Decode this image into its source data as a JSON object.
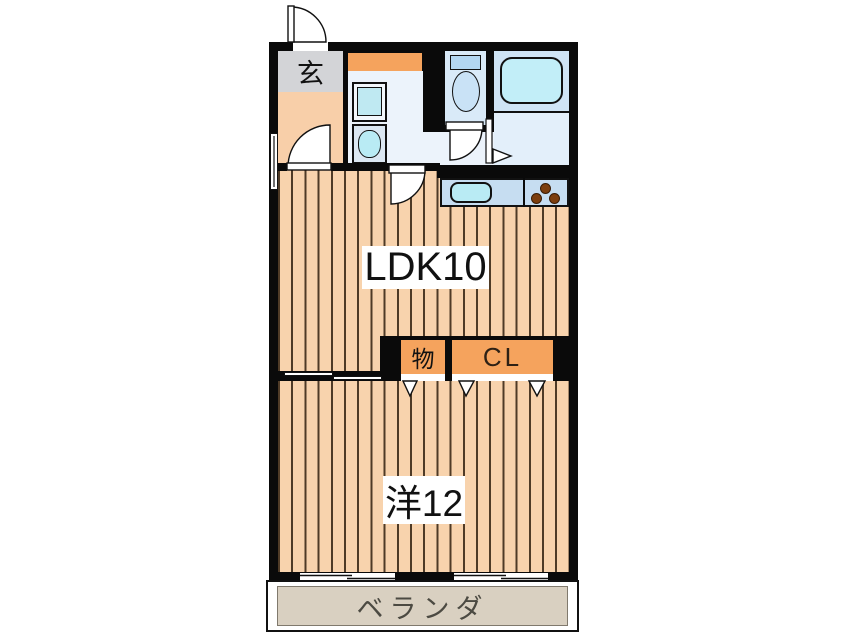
{
  "labels": {
    "ldk": "LDK10",
    "bedroom": "洋12",
    "entrance": "玄",
    "storage": "物",
    "closet": "CL",
    "veranda": "ベランダ"
  },
  "colors": {
    "wall": "#0a0a0a",
    "floor_base": "#f8d3ad",
    "floor_stripe": "#4f3b27",
    "hallway": "#f8cfa9",
    "genkan": "#d3d4d7",
    "accent_orange": "#f5a35d",
    "washroom": "#ecf3fb",
    "toilet_room": "#d9eaf8",
    "bath_upper": "#cfe4f5",
    "bath_lower": "#e3effa",
    "fixture_cyan": "#b9ebf4",
    "bathtub_cyan": "#c2eef8",
    "counter_blue": "#c6ddf1",
    "toilet_bowl": "#c9e2f6",
    "toilet_tank": "#b3d7f2",
    "machine_inner": "#bfe9f2",
    "burner_brown": "#7c3e0f",
    "veranda_fill": "#d9d0c1",
    "veranda_border": "#80796d",
    "veranda_text": "#4c4a42",
    "label_text": "#111111"
  }
}
